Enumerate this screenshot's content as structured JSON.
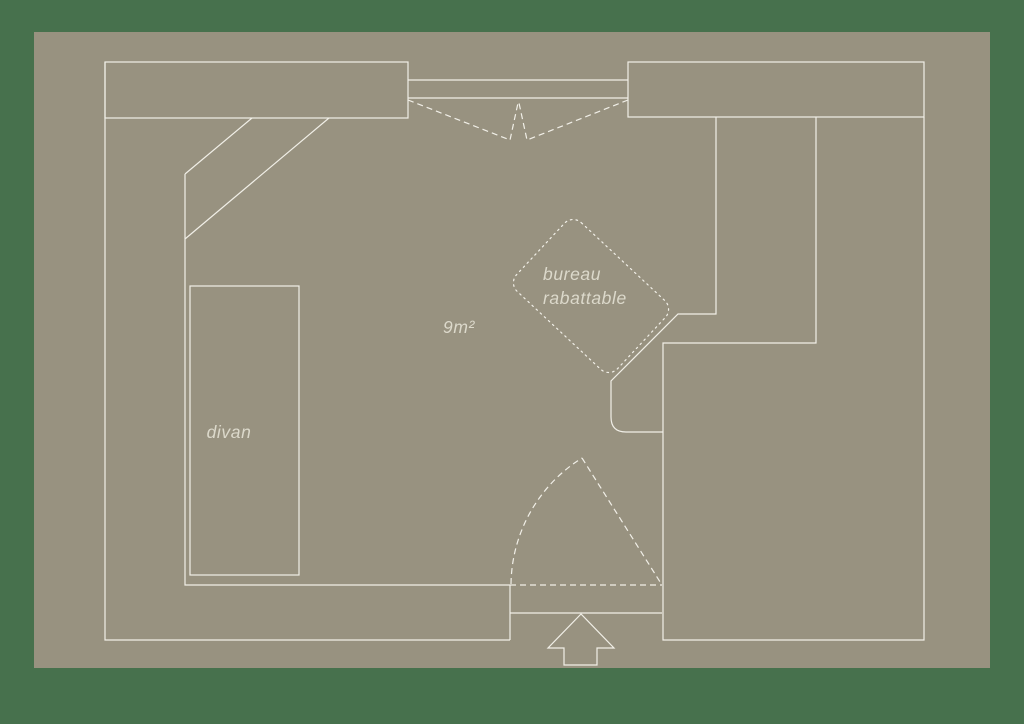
{
  "palette": {
    "background": "#47714d",
    "panel": "#989280",
    "line": "#f1efe7",
    "text": "#dcd9cb"
  },
  "floor_plan": {
    "area_label": "9m²",
    "divan_label": "divan",
    "desk_label_line1": "bureau",
    "desk_label_line2": "rabattable"
  }
}
